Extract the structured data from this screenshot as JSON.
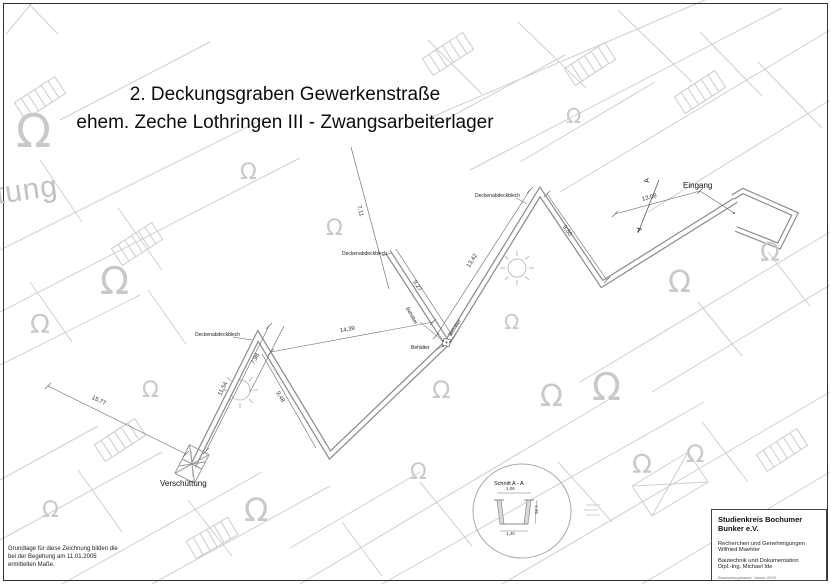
{
  "title": {
    "line1": "2. Deckungsgraben Gewerkenstraße",
    "line2": "ehem. Zeche Lothringen III - Zwangsarbeiterlager"
  },
  "note": {
    "line1": "Grundlage für diese Zeichnung bilden die",
    "line2": "bei der Begehung am 11.01.2005",
    "line3": "ermittelten Maße."
  },
  "title_block": {
    "org": "Studienkreis Bochumer Bunker e.V.",
    "role1": "Recherchen und Genehmigungen",
    "name1": "Wilfried Maehler",
    "role2": "Bautechnik und Dokumentation",
    "name2": "Dipl.-Ing. Michael Ide",
    "status": "Bearbeitungsstand: Januar 2005"
  },
  "plan": {
    "labels": {
      "entrance": "Eingang",
      "buried_end": "Verschüttung",
      "cover_sheet": "Deckenabdeckblech",
      "container": "Behälter",
      "section_marker": "A"
    },
    "dims": {
      "overall": "15,77",
      "leg1": "11,54",
      "leg1b": "7,98",
      "leg2": "9,48",
      "leg3": "14,39",
      "leg3b": "9,27",
      "vert": "7,11",
      "leg4": "13,42",
      "leg5": "9,50",
      "leg6": "13,08"
    }
  },
  "section_detail": {
    "title": "Schnitt A - A",
    "width_top": "1,06",
    "height": "1,46",
    "width_bottom": "1,40"
  },
  "background": {
    "omega": "Ω",
    "partial_text": "tung"
  },
  "colors": {
    "background_lines": "#cfcfcf",
    "trench_wall": "#8d8d8d",
    "dimension_lines": "#666666",
    "text": "#111111"
  }
}
